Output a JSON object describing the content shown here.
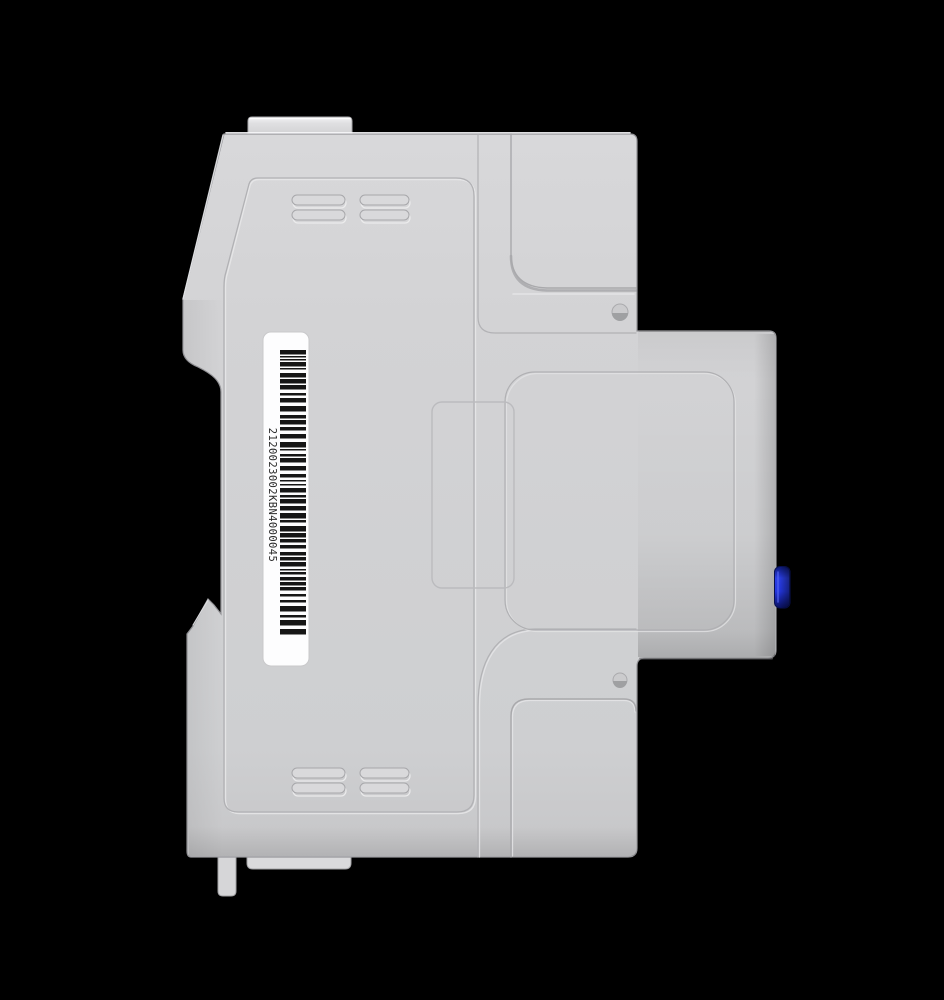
{
  "scene": {
    "background": "#000000",
    "description": "Side view 3D render of a gray DIN-rail mounted energy meter enclosure"
  },
  "meter": {
    "body_color": "#d2d2d4",
    "edge_color": "#96969a",
    "highlight_color": "#f4f4f6",
    "seam_color": "#b2b2b5",
    "button_color": "#2a3ee5",
    "button_dark_color": "#0a1468",
    "screw_color": "#c9c9cb",
    "barcode": {
      "serial": "2120023002KBN4000045",
      "label_color": "#fdfdfe",
      "bar_color": "#161616",
      "text_color": "#2a2a2a"
    }
  }
}
